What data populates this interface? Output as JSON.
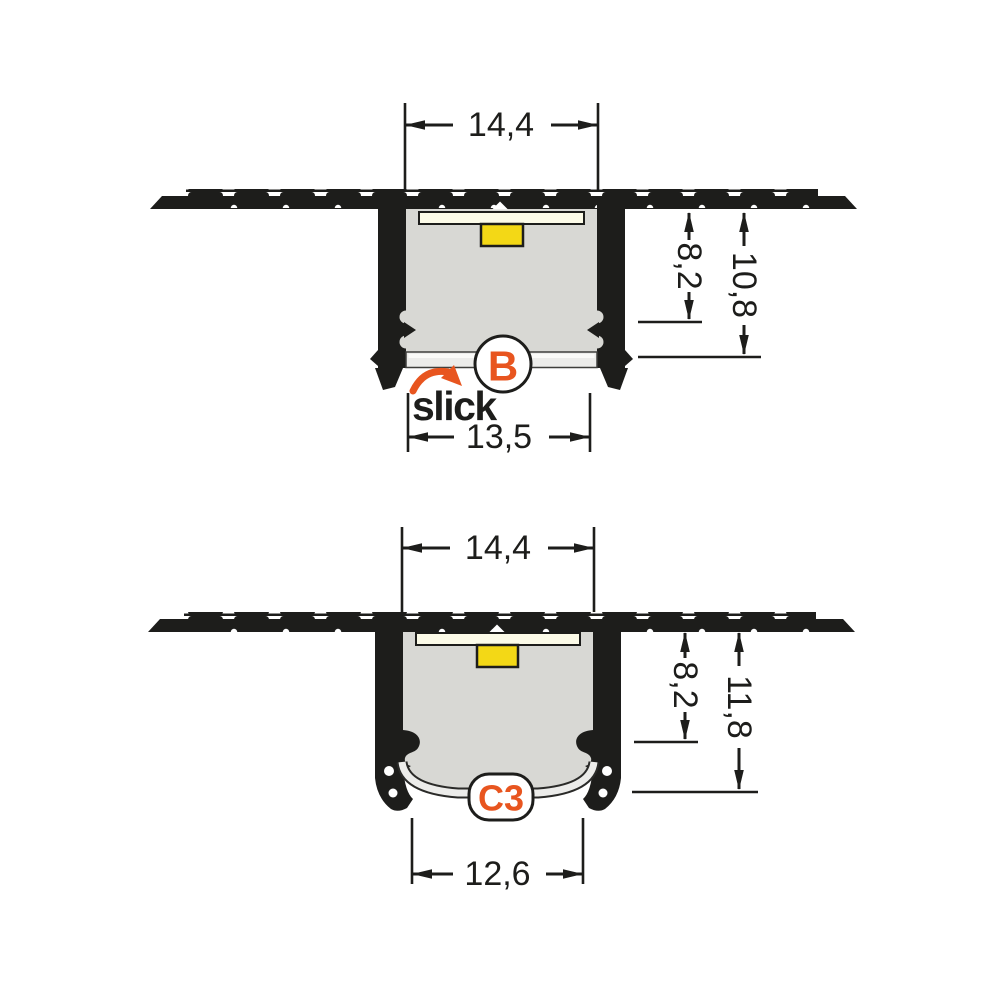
{
  "colors": {
    "accent": "#e8551f",
    "ink": "#1d1d1b",
    "interior": "#d8d8d4",
    "pcb": "#fcfbe8",
    "led": "#f3d816",
    "diffuser": "#ececea",
    "diffuser_hi": "#fafaf8",
    "bg": "#ffffff"
  },
  "diagram_b": {
    "label": "B",
    "brand": "slick",
    "dims": {
      "top_width": "14,4",
      "bottom_width": "13,5",
      "recess_depth": "8,2",
      "total_depth": "10,8"
    }
  },
  "diagram_c3": {
    "label": "C3",
    "dims": {
      "top_width": "14,4",
      "bottom_width": "12,6",
      "recess_depth": "8,2",
      "total_depth": "11,8"
    }
  }
}
